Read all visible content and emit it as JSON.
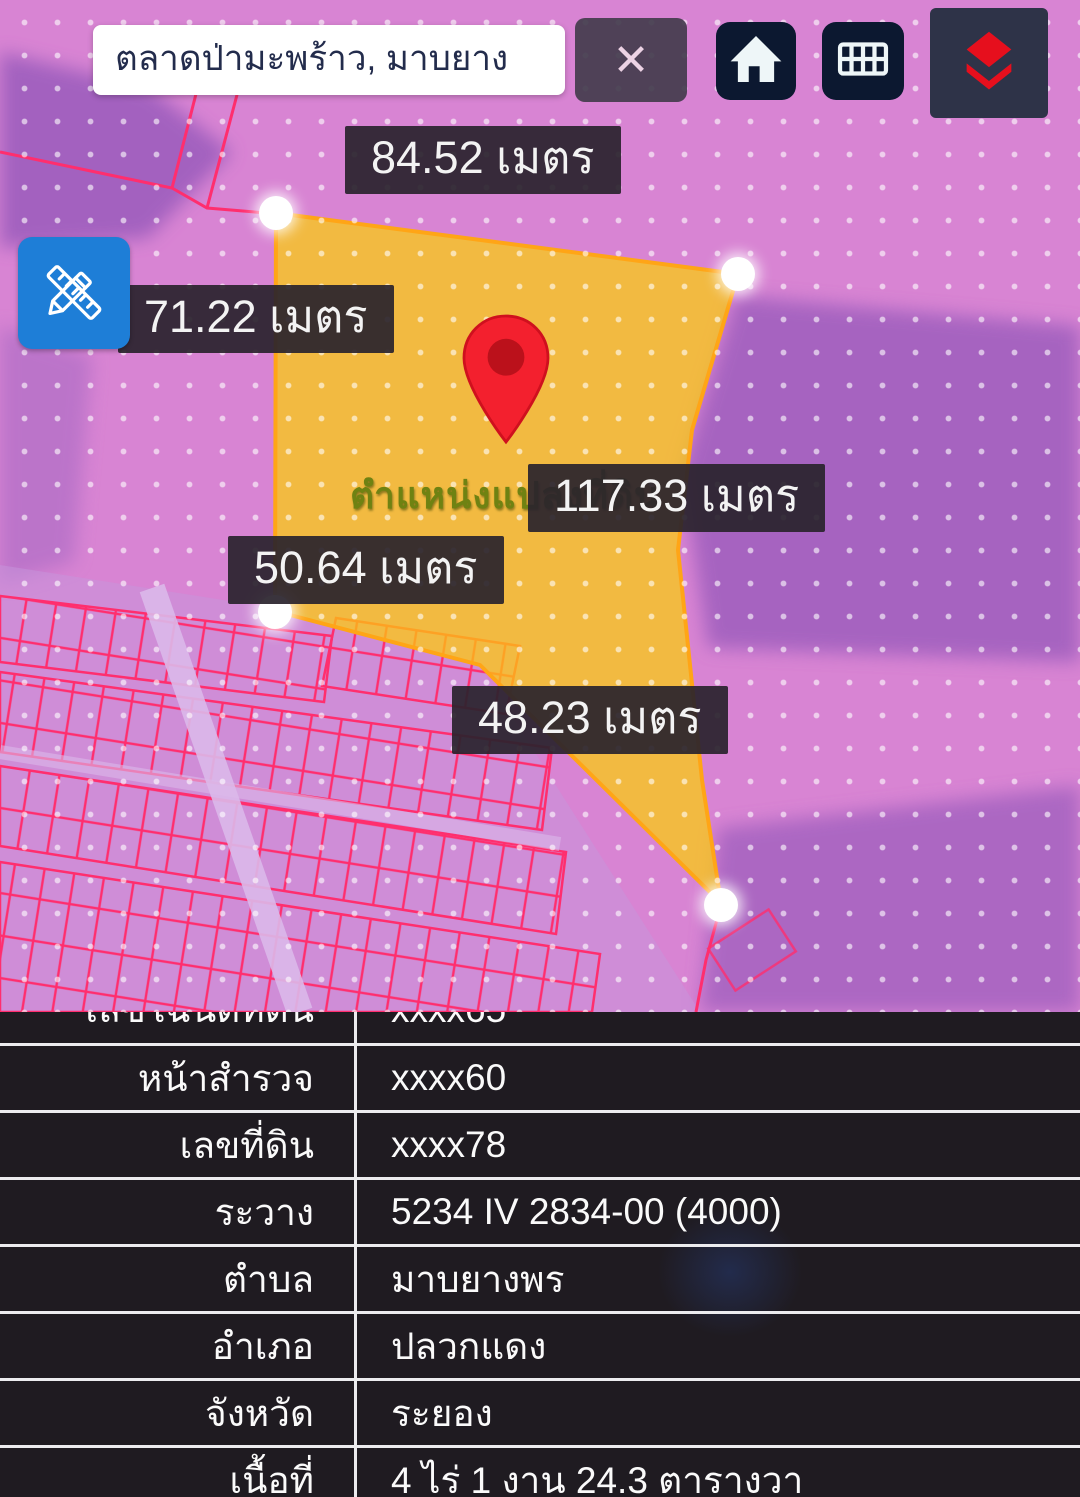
{
  "topbar": {
    "search_value": "ตลาดป่ามะพร้าว, มาบยาง",
    "clear_icon": "✕"
  },
  "map": {
    "parcel_position_label": "ตำแหน่งแปลงที่ดิน",
    "unit": "เมตร",
    "measurements": [
      {
        "side": "top",
        "text": "84.52 เมตร"
      },
      {
        "side": "upper-left",
        "text": "71.22 เมตร"
      },
      {
        "side": "right",
        "text": "117.33 เมตร"
      },
      {
        "side": "lower-left",
        "text": "50.64 เมตร"
      },
      {
        "side": "bottom",
        "text": "48.23 เมตร"
      }
    ]
  },
  "parcel_info": {
    "rows": [
      {
        "label": "เลขโฉนดที่ดิน",
        "value": "xxxx65"
      },
      {
        "label": "หน้าสำรวจ",
        "value": "xxxx60"
      },
      {
        "label": "เลขที่ดิน",
        "value": "xxxx78"
      },
      {
        "label": "ระวาง",
        "value": "5234 IV 2834-00 (4000)"
      },
      {
        "label": "ตำบล",
        "value": "มาบยางพร"
      },
      {
        "label": "อำเภอ",
        "value": "ปลวกแดง"
      },
      {
        "label": "จังหวัด",
        "value": "ระยอง"
      },
      {
        "label": "เนื้อที่",
        "value": "4 ไร่ 1 งาน 24.3 ตารางวา"
      }
    ]
  },
  "colors": {
    "map_pink": "#d884d3",
    "map_purple": "#9a5cbc",
    "cadastral_line": "#ff2e6e",
    "parcel_fill": "#fccf08",
    "parcel_stroke": "#ffa516",
    "accent_blue": "#1e7ed7",
    "pin_red": "#f3202e",
    "layers_red": "#e60f1d",
    "label_bg": "#2a242c",
    "table_bg": "#1f1b21"
  }
}
